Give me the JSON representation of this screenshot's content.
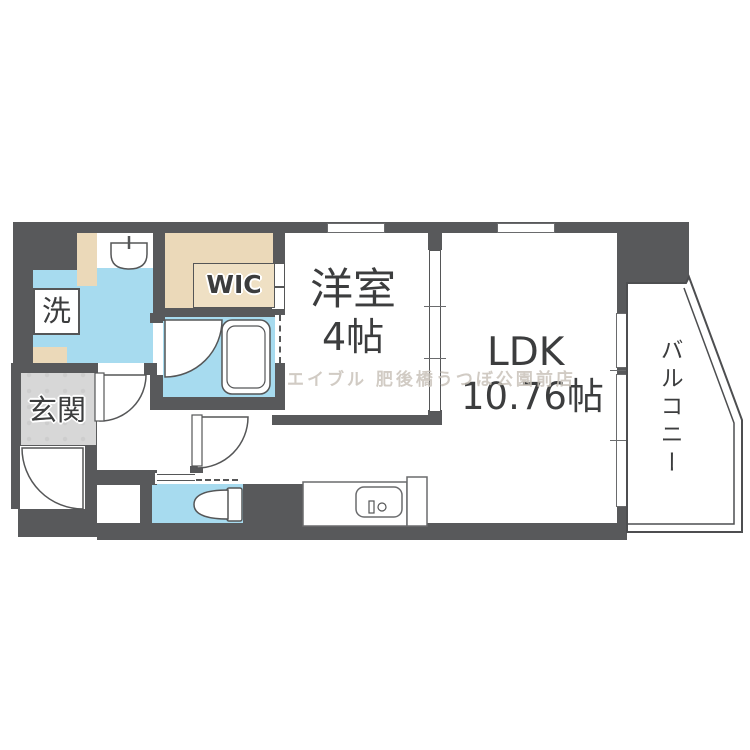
{
  "plan": {
    "title": "apartment-floor-plan",
    "rooms": {
      "entrance": {
        "label": "玄関"
      },
      "laundry": {
        "label": "洗"
      },
      "wic": {
        "label": "WIC"
      },
      "western_room": {
        "label": "洋室",
        "size": "4帖"
      },
      "ldk": {
        "label": "LDK",
        "size": "10.76帖"
      },
      "balcony": {
        "label": "バルコニー"
      }
    },
    "watermark": "エイブル 肥後橋うつぼ公園前店",
    "fixtures": {
      "toilet": "toilet-icon",
      "bathtub": "bathtub-icon",
      "kitchen_sink": "kitchen-sink-icon",
      "wash_basin": "wash-basin-icon"
    },
    "colors": {
      "wall": "#58595b",
      "wet_area": "#a7dbef",
      "storage": "#ebd9b9",
      "entrance_floor": "#d7d7d7",
      "outline": "#555657",
      "text": "#3c3d3e",
      "watermark": "#c9c3ba"
    }
  }
}
